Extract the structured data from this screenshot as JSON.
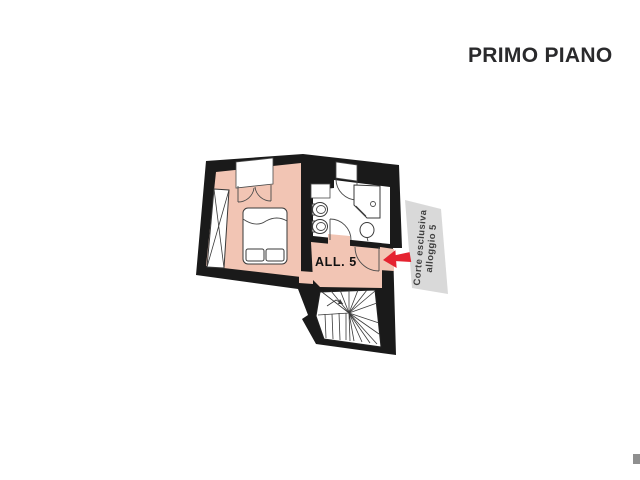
{
  "header": {
    "title": "PRIMO PIANO"
  },
  "floor_plan": {
    "unit_label": "ALL. 5",
    "courtyard_banner": {
      "line1": "Corte esclusiva",
      "line2": "alloggio 5"
    },
    "colors": {
      "floor": "#f2c5b4",
      "walls": "#1a1a1a",
      "arrow": "#e52330",
      "banner": "#d9d9d9",
      "title_text": "#2a2a2c",
      "fixture_stroke": "#3a3a3a"
    }
  }
}
